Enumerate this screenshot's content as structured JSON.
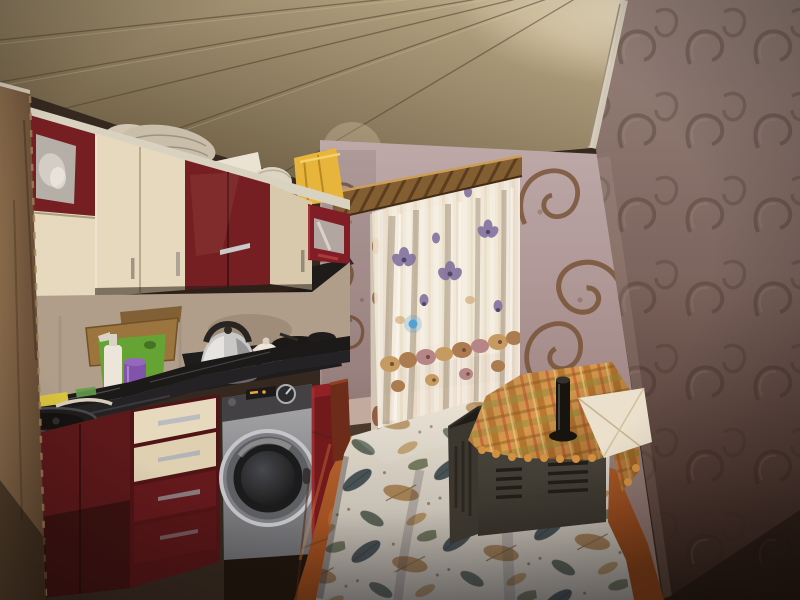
{
  "watermarks": {
    "top_left": "Yeniemlak.az",
    "center": "Yeniemlak.az",
    "bottom_right": "Yeniemlak.az"
  },
  "palette": {
    "cabinet_red": "#6f1820",
    "cabinet_red_dark": "#4e0d13",
    "cabinet_cream": "#e6dcc2",
    "counter_black": "#101116",
    "wall_mauve": "#8d7a76",
    "wall_light": "#b5a3a6",
    "ceiling_tan": "#9a8c6f",
    "floor_terracotta": "#a8571f",
    "curtain_cream": "#f3edde",
    "washer_silver": "#8f939b",
    "tablecloth_cream": "#ebe6d9",
    "plaid_orange": "#d69a4c",
    "microwave_gray": "#3f3f3b"
  }
}
